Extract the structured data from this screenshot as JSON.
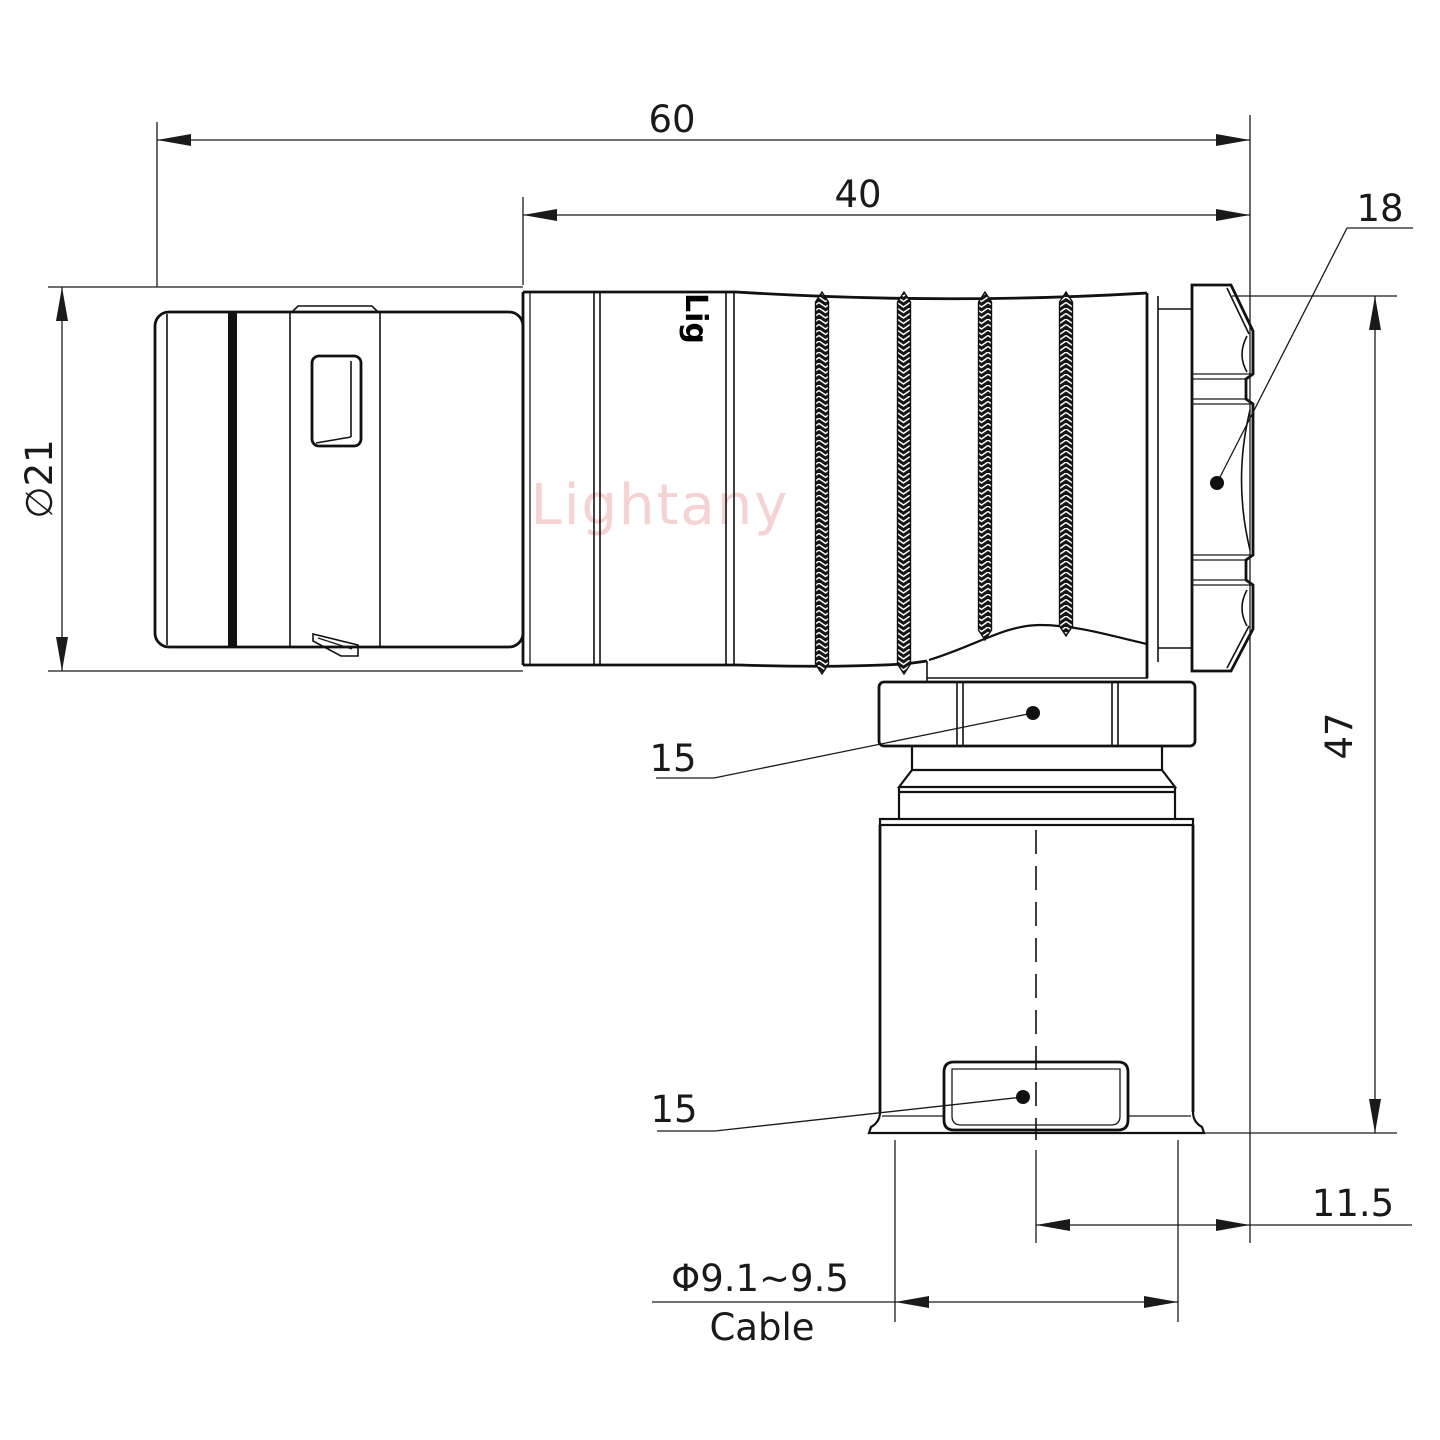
{
  "drawing": {
    "type": "right-angle circular connector, dimensioned side view",
    "colors": {
      "line": "#111111",
      "background": "#ffffff",
      "watermark": "#f6d2d2"
    },
    "watermark": {
      "text": "Lightany"
    },
    "stamp": {
      "text": "Lig"
    },
    "dims": {
      "overall_length": "60",
      "front_length": "40",
      "rear_nut": "18",
      "body_diameter": "∅21",
      "elbow_nut_width": "15",
      "cable_nut_width": "15",
      "overall_height": "47",
      "axis_offset": "11.5",
      "cable_diameter": "Φ9.1~9.5",
      "cable_label": "Cable"
    }
  }
}
